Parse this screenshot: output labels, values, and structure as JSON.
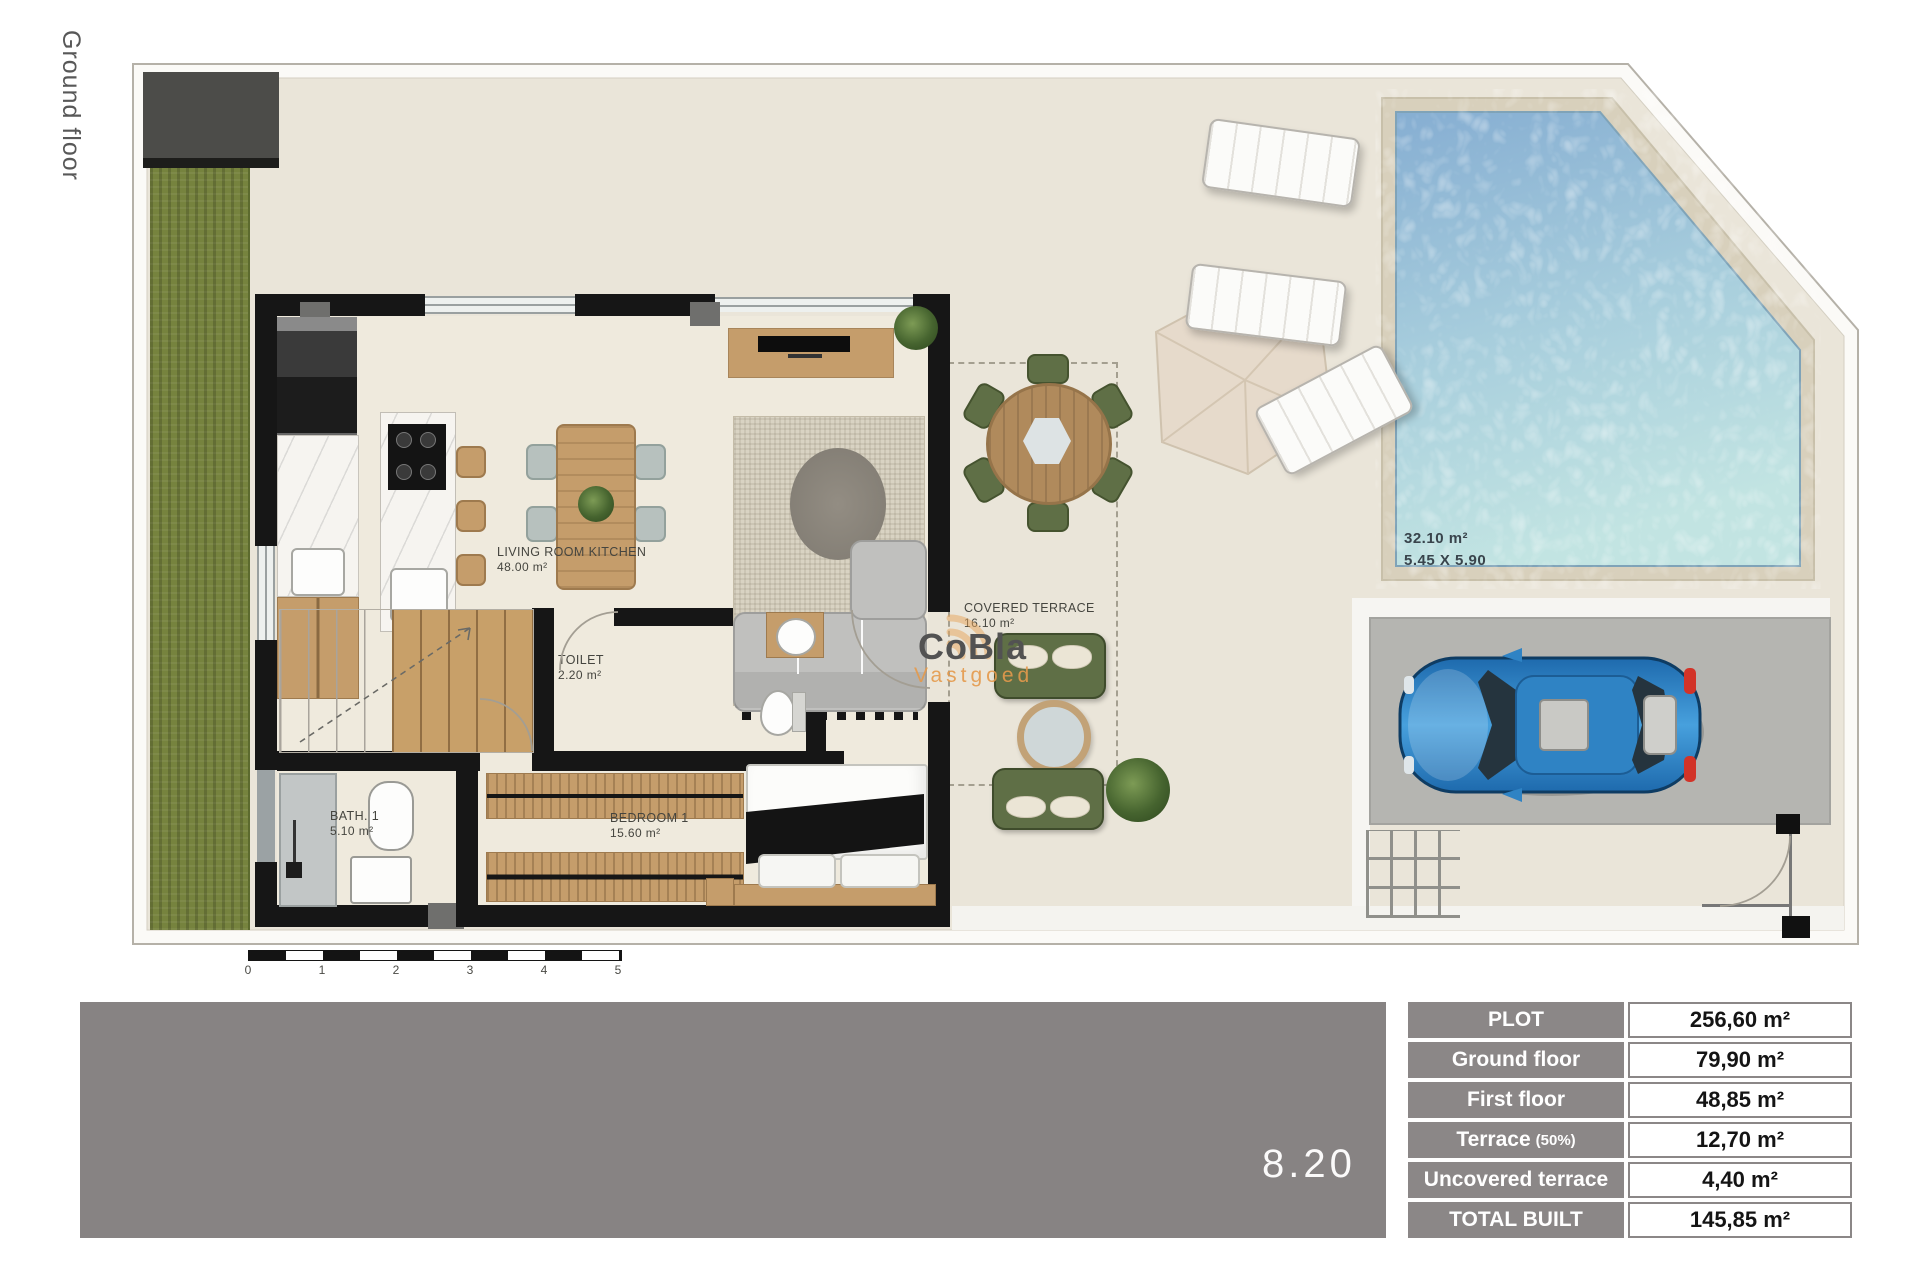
{
  "page": {
    "floor_label": "Ground floor",
    "plan_number": "8.20",
    "watermark": {
      "name": "CoBla",
      "subtitle": "Vastgoed"
    }
  },
  "rooms": [
    {
      "name": "LIVING ROOM KITCHEN",
      "area": "48.00 m²"
    },
    {
      "name": "TOILET",
      "area": "2.20 m²"
    },
    {
      "name": "BATH. 1",
      "area": "5.10 m²"
    },
    {
      "name": "BEDROOM 1",
      "area": "15.60 m²"
    },
    {
      "name": "COVERED TERRACE",
      "area": "16.10 m²"
    }
  ],
  "pool": {
    "area": "32.10 m²",
    "dimensions": "5.45 X 5.90"
  },
  "scale_bar": {
    "ticks": [
      "0",
      "1",
      "2",
      "3",
      "4",
      "5"
    ]
  },
  "areas_table": {
    "rows": [
      {
        "label": "PLOT",
        "suffix": "",
        "value": "256,60 m²"
      },
      {
        "label": "Ground floor",
        "suffix": "",
        "value": "79,90 m²"
      },
      {
        "label": "First floor",
        "suffix": "",
        "value": "48,85 m²"
      },
      {
        "label": "Terrace",
        "suffix": "(50%)",
        "value": "12,70 m²"
      },
      {
        "label": "Uncovered terrace",
        "suffix": "",
        "value": "4,40 m²"
      },
      {
        "label": "TOTAL BUILT",
        "suffix": "",
        "value": "145,85 m²"
      }
    ]
  },
  "colors": {
    "wall": "#161616",
    "plot": "#eae5d9",
    "grass": "#76833e",
    "pool_top": "#86aed2",
    "pool_bottom": "#c2e4e2",
    "wood": "#c59d6b",
    "sofa_green": "#5f6f46",
    "car_blue": "#2f83c4",
    "panel_gray": "#878383",
    "table_header": "#8b8787",
    "accent_orange": "#e59a4c"
  }
}
